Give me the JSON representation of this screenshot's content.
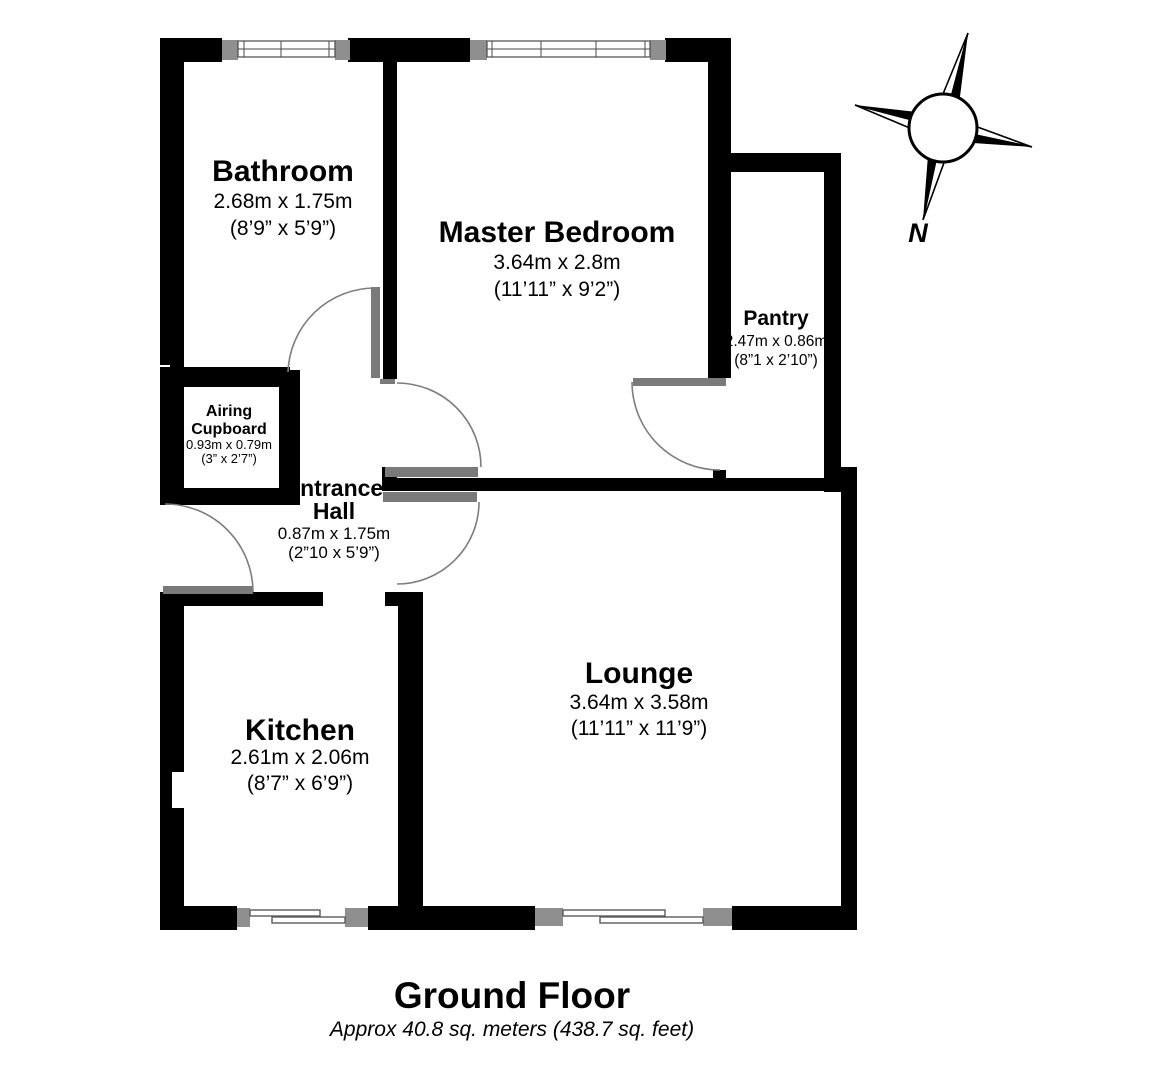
{
  "title": {
    "floor": "Ground Floor",
    "area": "Approx 40.8 sq. meters (438.7 sq. feet)"
  },
  "compass": {
    "north_label": "N"
  },
  "rooms": {
    "bathroom": {
      "name": "Bathroom",
      "metric": "2.68m x 1.75m",
      "imperial": "(8’9” x 5’9”)"
    },
    "master_bedroom": {
      "name": "Master Bedroom",
      "metric": "3.64m x 2.8m",
      "imperial": "(11’11” x 9’2”)"
    },
    "pantry": {
      "name": "Pantry",
      "metric": "2.47m x 0.86m",
      "imperial": "(8”1 x 2’10”)"
    },
    "airing_cupboard": {
      "name_line1": "Airing",
      "name_line2": "Cupboard",
      "metric": "0.93m x 0.79m",
      "imperial": "(3” x 2’7”)"
    },
    "entrance_hall": {
      "name_line1": "Entrance",
      "name_line2": "Hall",
      "metric": "0.87m x 1.75m",
      "imperial": "(2”10 x 5’9”)"
    },
    "kitchen": {
      "name": "Kitchen",
      "metric": "2.61m x 2.06m",
      "imperial": "(8’7” x 6’9”)"
    },
    "lounge": {
      "name": "Lounge",
      "metric": "3.64m x 3.58m",
      "imperial": "(11’11” x 11’9”)"
    }
  },
  "colors": {
    "wall": "#000000",
    "door": "#7a7a7a",
    "window_cap": "#8f8f8f",
    "background": "#ffffff"
  }
}
